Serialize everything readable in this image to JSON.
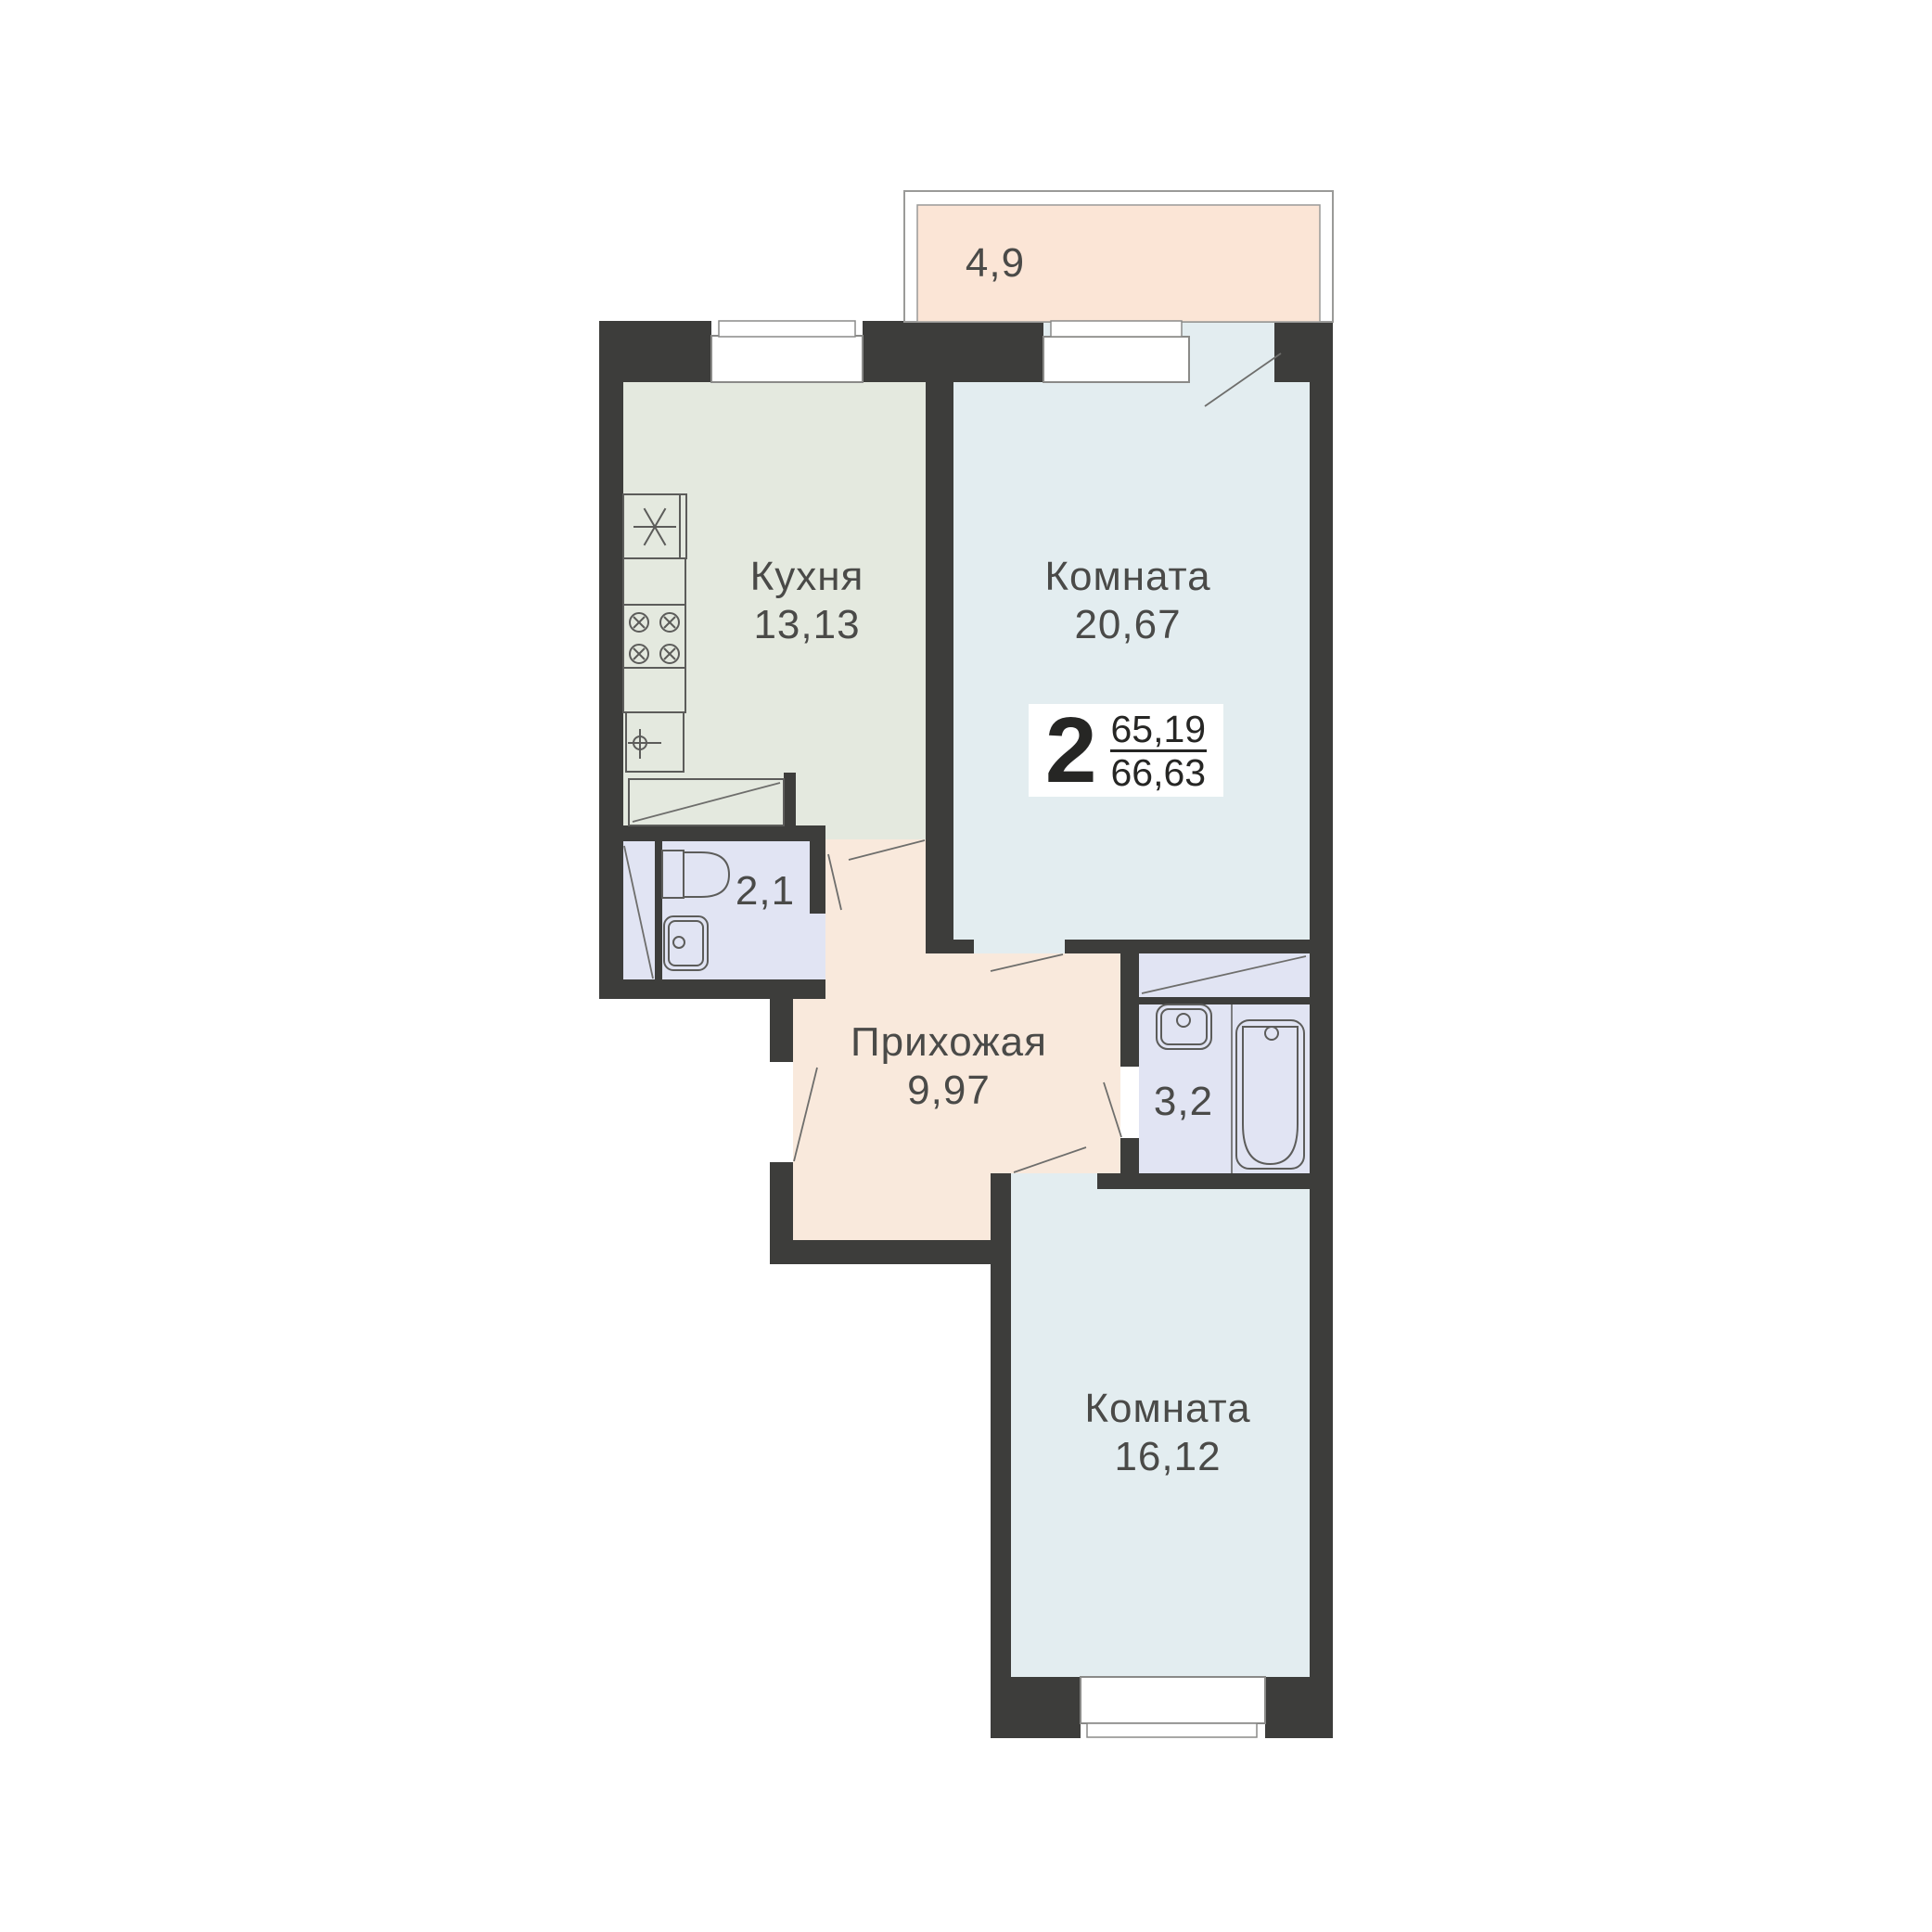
{
  "plan": {
    "title": "2-room apartment floor plan",
    "type_badge": {
      "rooms_count": "2",
      "area_upper": "65,19",
      "area_lower": "66,63"
    },
    "rooms": {
      "kitchen": {
        "name": "Кухня",
        "area": "13,13"
      },
      "living_room": {
        "name": "Комната",
        "area": "20,67"
      },
      "bedroom": {
        "name": "Комната",
        "area": "16,12"
      },
      "hallway": {
        "name": "Прихожая",
        "area": "9,97"
      },
      "wc": {
        "area": "2,1"
      },
      "bathroom": {
        "area": "3,2"
      },
      "balcony": {
        "area": "4,9"
      }
    },
    "colors": {
      "wall": "#3d3d3b",
      "kitchen_fill": "#e4e9df",
      "room_fill": "#e3edf0",
      "wet_room_fill": "#e1e4f3",
      "hallway_fill": "#f9e9dc",
      "balcony_fill": "#fbe5d6",
      "text": "#4a4a48",
      "badge_text": "#262624"
    }
  }
}
